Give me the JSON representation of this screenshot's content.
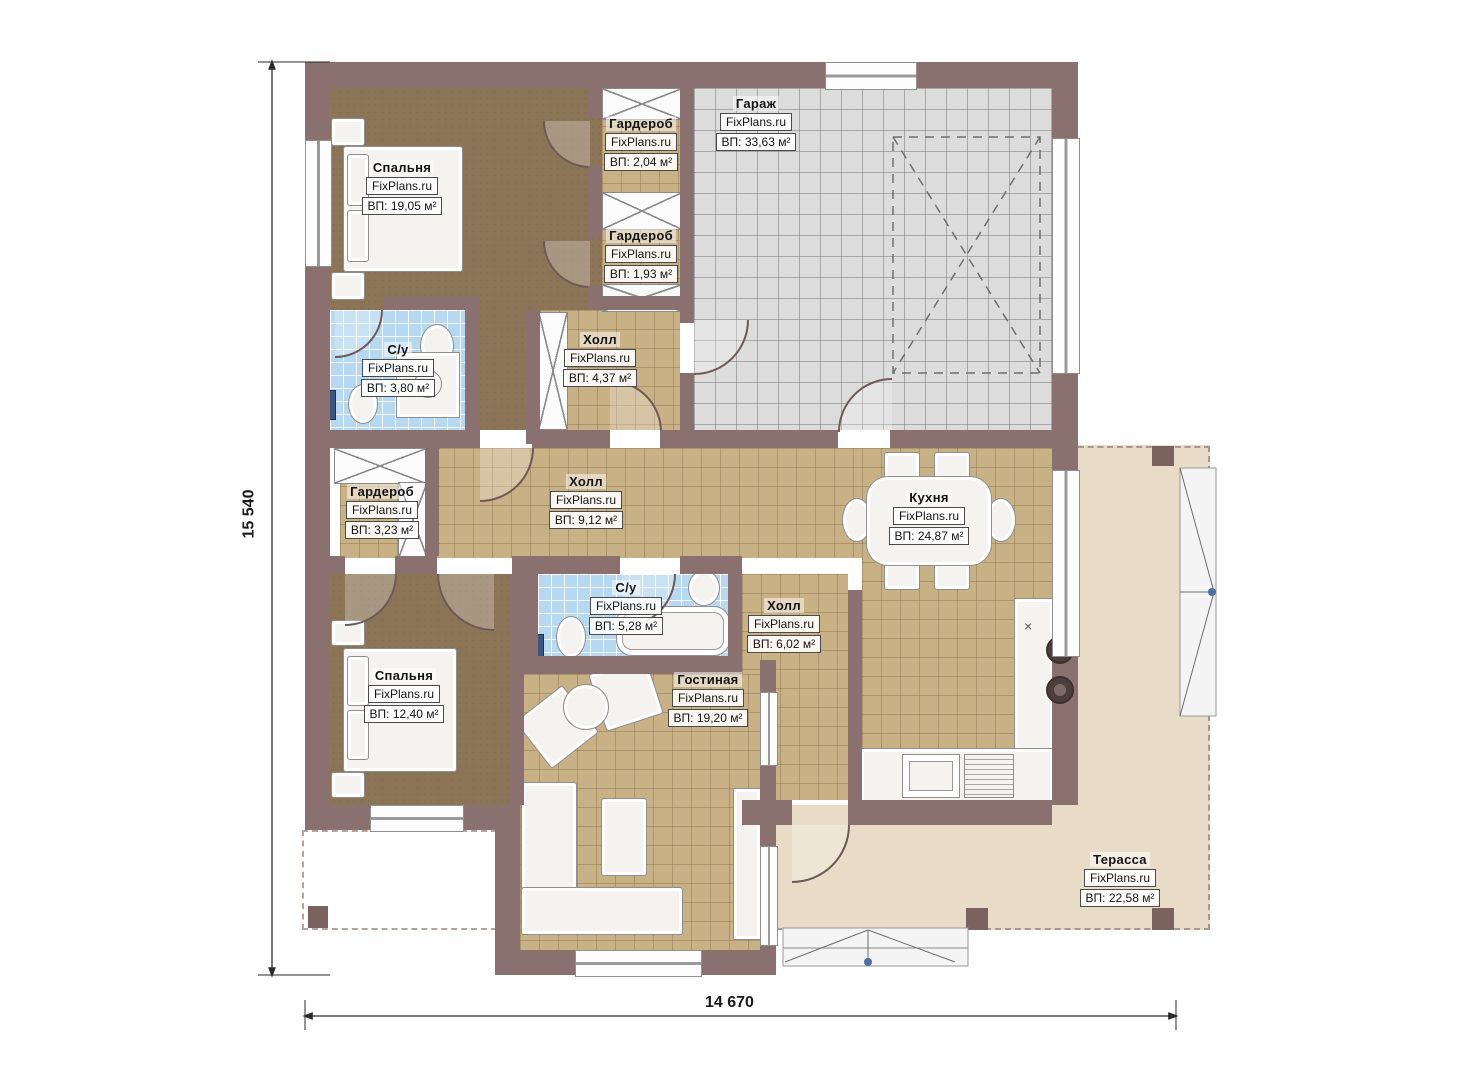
{
  "meta": {
    "brand": "FixPlans.ru"
  },
  "dimensions": {
    "height_label": "15 540",
    "width_label": "14 670"
  },
  "colors": {
    "wall": "#8a7170",
    "floor_tile": "#c9b186",
    "floor_carpet": "#8c7557",
    "floor_garage": "#dcdcdc",
    "floor_bath": "#b6d8f1",
    "terrace": "#e9dcc7"
  },
  "rooms": [
    {
      "name": "Спальня",
      "area": "ВП: 19,05 м²"
    },
    {
      "name": "Гардероб",
      "area": "ВП: 2,04 м²"
    },
    {
      "name": "Гардероб",
      "area": "ВП: 1,93 м²"
    },
    {
      "name": "Гараж",
      "area": "ВП: 33,63 м²"
    },
    {
      "name": "С/у",
      "area": "ВП: 3,80 м²"
    },
    {
      "name": "Холл",
      "area": "ВП: 4,37 м²"
    },
    {
      "name": "Гардероб",
      "area": "ВП: 3,23 м²"
    },
    {
      "name": "Холл",
      "area": "ВП: 9,12 м²"
    },
    {
      "name": "Кухня",
      "area": "ВП: 24,87 м²"
    },
    {
      "name": "С/у",
      "area": "ВП: 5,28 м²"
    },
    {
      "name": "Холл",
      "area": "ВП: 6,02 м²"
    },
    {
      "name": "Спальня",
      "area": "ВП: 12,40 м²"
    },
    {
      "name": "Гостиная",
      "area": "ВП: 19,20 м²"
    },
    {
      "name": "Терасса",
      "area": "ВП: 22,58 м²"
    }
  ]
}
